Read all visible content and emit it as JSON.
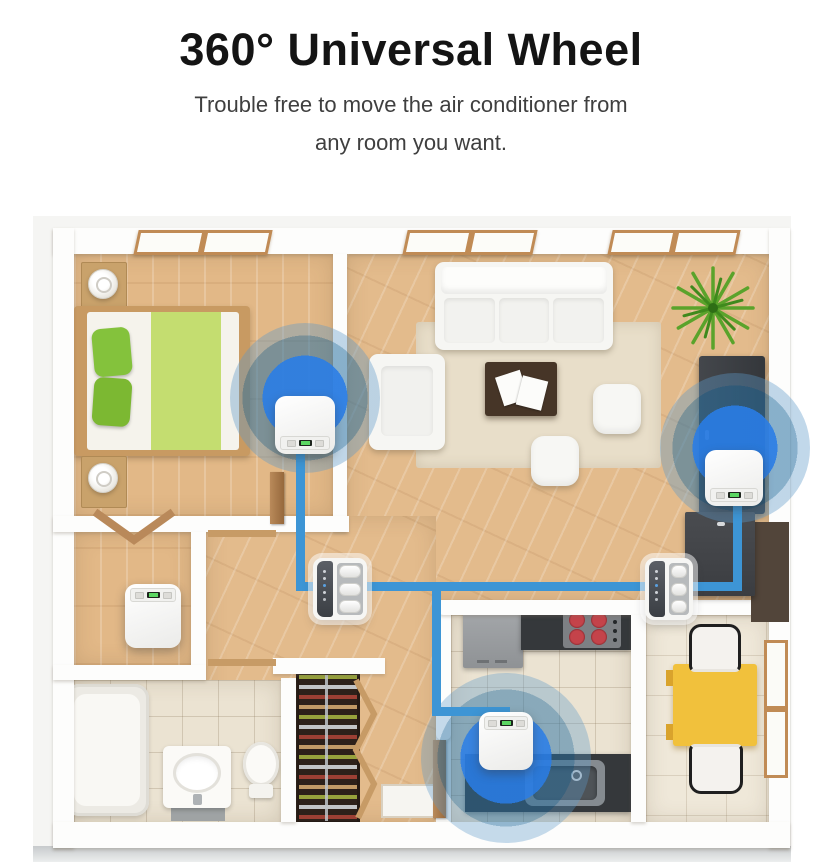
{
  "header": {
    "title": "360° Universal Wheel",
    "subtitle_line1": "Trouble free to move the air conditioner from",
    "subtitle_line2": "any room you want."
  },
  "colors": {
    "title_text": "#141414",
    "subtitle_text": "#3f3f3f",
    "path_blue": "#3d95d5",
    "ripple_blue": "#297ce2",
    "wood_floor": "#e2b887",
    "tile_floor": "#ebe3d2",
    "wall_white": "#fdfdfc",
    "table_yellow": "#f1c13c",
    "bed_green": "#84c23c"
  },
  "floorplan": {
    "rooms": [
      "bedroom",
      "living-room",
      "hallway",
      "laundry-room",
      "bathroom",
      "shoe-closet",
      "entry",
      "kitchen",
      "dining-area"
    ],
    "ac_units": [
      {
        "id": "bedroom-ac",
        "view": "top",
        "ripple": true
      },
      {
        "id": "living-room-ac",
        "view": "top",
        "ripple": true
      },
      {
        "id": "kitchen-ac",
        "view": "top",
        "ripple": true
      },
      {
        "id": "laundry-ac",
        "view": "top",
        "ripple": false
      },
      {
        "id": "hallway-ac",
        "view": "front",
        "ripple": false
      },
      {
        "id": "dining-side-ac",
        "view": "front",
        "ripple": false
      }
    ]
  }
}
